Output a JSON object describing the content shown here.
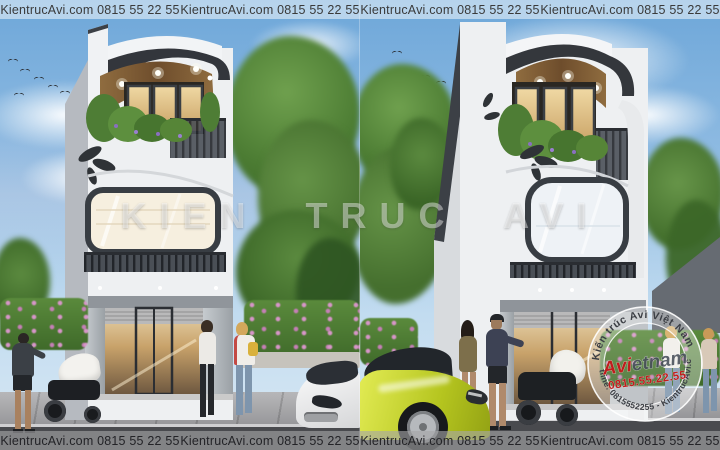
{
  "strip": {
    "text": "KientrucAvi.com 0815 55 22 55"
  },
  "watermark": {
    "center": "KIEN TRUC AVI"
  },
  "stamp": {
    "arc_top": "Kiến trúc Avi Việt Nam",
    "brand_prefix": "Avi",
    "brand_suffix": "etnam",
    "phone_large": "0815.55.22.55",
    "arc_bottom": "Hotline: 0815552255 - KientrucAvi.com",
    "red": "#c01d1d",
    "dark": "#3c4250"
  },
  "colors": {
    "sky_top": "#6ea7d9",
    "sky_bottom": "#d9e8f4",
    "facade_white": "#eef0f2",
    "trim_dark": "#33363c",
    "wood_soffit": "#7a5836",
    "foliage": "#4e7d35",
    "flower_pink": "#d795c8",
    "car_yellow": "#bfd02c",
    "road": "#494a4e",
    "sidewalk": "#a9a9ab"
  }
}
